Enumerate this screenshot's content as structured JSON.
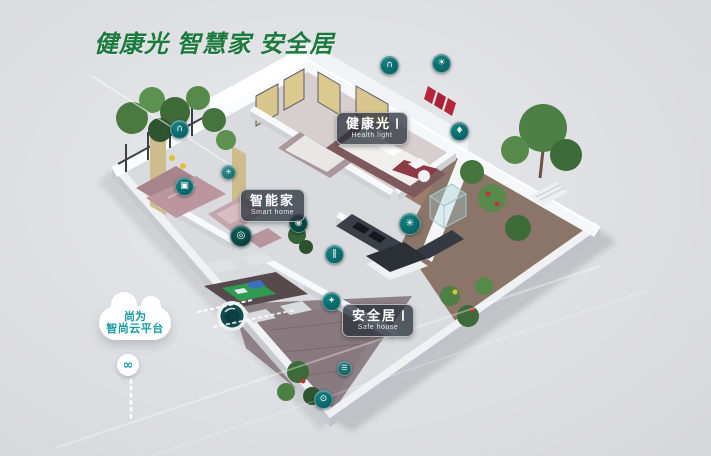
{
  "title": "健康光 智慧家 安全居",
  "feature_labels": [
    {
      "zh": "健康光",
      "en": "Health light"
    },
    {
      "zh": "智能家",
      "en": "Smart home"
    },
    {
      "zh": "安全居",
      "en": "Safe house"
    }
  ],
  "cloud": {
    "line1": "尚为",
    "line2": "智尚云平台",
    "link_glyph": "∞"
  },
  "icons": [
    {
      "name": "balcony-curtain-icon",
      "glyph": "∩"
    },
    {
      "name": "tv-icon",
      "glyph": "▣"
    },
    {
      "name": "balcony-light-icon",
      "glyph": "☀"
    },
    {
      "name": "vacuum-robot-icon",
      "glyph": "◎"
    },
    {
      "name": "camera-icon",
      "glyph": "◉"
    },
    {
      "name": "indoor-door-icon",
      "glyph": "‖"
    },
    {
      "name": "bedroom-curtain-icon",
      "glyph": "∩"
    },
    {
      "name": "ceiling-light-icon",
      "glyph": "☀"
    },
    {
      "name": "kitchen-fan-icon",
      "glyph": "✳"
    },
    {
      "name": "water-icon",
      "glyph": "♦"
    },
    {
      "name": "security-shield-icon",
      "glyph": "✦"
    },
    {
      "name": "sensor-icon",
      "glyph": "☰"
    },
    {
      "name": "door-lock-icon",
      "glyph": "⊙"
    }
  ],
  "colors": {
    "title_green": "#1d7a3f",
    "accent_teal": "#0c6f6f",
    "cloud_text": "#189a9e",
    "label_bg": "rgba(38,44,54,0.74)"
  }
}
